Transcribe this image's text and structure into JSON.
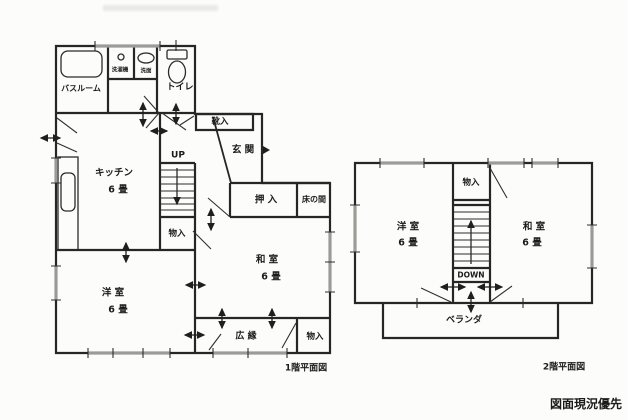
{
  "note": "図面現況優先",
  "floor1": {
    "caption": "1階平面図",
    "labels": {
      "bathroom": "バスルーム",
      "washing_machine": "洗濯機",
      "washstand": "洗面",
      "toilet": "トイレ",
      "shoe_cabinet": "靴入",
      "entrance": "玄 関",
      "kitchen_name": "キッチン",
      "kitchen_size": "6 畳",
      "stairs_up": "UP",
      "closet_by_stairs": "物入",
      "oshiire_closet": "押 入",
      "tokonoma": "床の間",
      "japanese_room_name": "和 室",
      "japanese_room_size": "6 畳",
      "western_room_name": "洋 室",
      "western_room_size": "6 畳",
      "veranda_corridor": "広 縁",
      "closet_southeast": "物入"
    }
  },
  "floor2": {
    "caption": "2階平面図",
    "labels": {
      "closet": "物入",
      "western_room_name": "洋 室",
      "western_room_size": "6 畳",
      "japanese_room_name": "和 室",
      "japanese_room_size": "6 畳",
      "stairs_down": "DOWN",
      "balcony": "ベランダ"
    }
  }
}
